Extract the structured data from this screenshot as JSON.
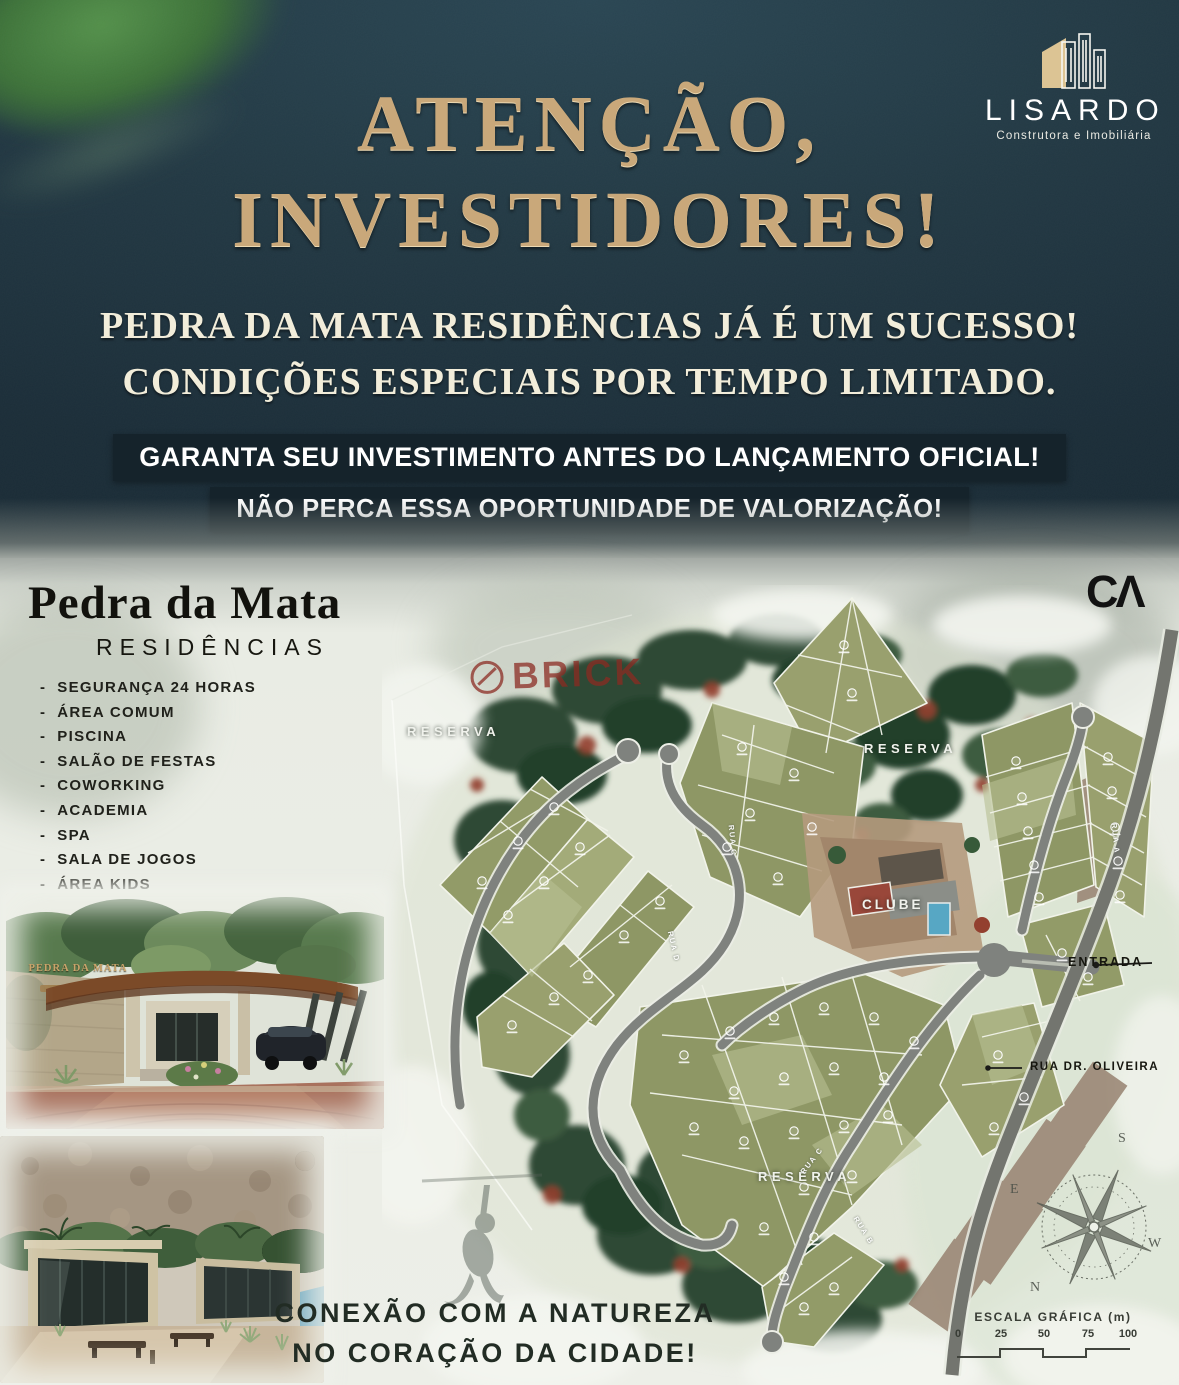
{
  "brand": {
    "name": "LISARDO",
    "tagline": "Construtora e Imobiliária"
  },
  "hero": {
    "headline_line1": "ATENÇÃO,",
    "headline_line2": "INVESTIDORES!",
    "subheadline_line1": "PEDRA DA MATA RESIDÊNCIAS JÁ É UM SUCESSO!",
    "subheadline_line2": "CONDIÇÕES ESPECIAIS POR TEMPO LIMITADO.",
    "banner_line1": "GARANTA SEU INVESTIMENTO ANTES DO LANÇAMENTO OFICIAL!",
    "banner_line2": "NÃO PERCA ESSA OPORTUNIDADE DE VALORIZAÇÃO!"
  },
  "project": {
    "title": "Pedra da Mata",
    "subtitle": "RESIDÊNCIAS",
    "amenities": [
      "SEGURANÇA 24 HORAS",
      "ÁREA COMUM",
      "PISCINA",
      "SALÃO DE FESTAS",
      "COWORKING",
      "ACADEMIA",
      "SPA",
      "SALA DE JOGOS",
      "ÁREA KIDS",
      "QUADRA POLIESPORTIVA",
      "QUADRAS DE BEACH TENNIS E VÔLEI",
      "ESCALADA",
      "TRILHAS"
    ]
  },
  "gate_sign": "PEDRA DA MATA",
  "masterplan": {
    "corner_logo": "CΛ",
    "watermark": "BRICK",
    "labels": {
      "reserva": "RESERVA",
      "clube": "CLUBE",
      "entrada": "ENTRADA",
      "rua_dr_oliveira": "RUA DR. OLIVEIRA"
    },
    "road_labels": {
      "rua_a": "RUA A",
      "rua_b": "RUA B",
      "rua_c": "RUA C",
      "rua_d": "RUA D"
    },
    "compass": {
      "n": "N",
      "s": "S",
      "e": "E",
      "w": "W"
    },
    "scale": {
      "title": "ESCALA GRÁFICA (m)",
      "ticks": [
        "0",
        "25",
        "50",
        "75",
        "100"
      ]
    }
  },
  "footer": {
    "line1": "CONEXÃO COM A NATUREZA",
    "line2": "NO CORAÇÃO DA CIDADE!"
  },
  "colors": {
    "hero_bg": "#203540",
    "gold": "#c9a87a",
    "banner_bg": "#15232b",
    "cream": "#f2edda",
    "page_bg": "#e9ece4",
    "lot_green": "#8e9765",
    "road_gray": "#7f827e",
    "forest_dark": "#2e4a34",
    "accent_red": "#93402f"
  }
}
